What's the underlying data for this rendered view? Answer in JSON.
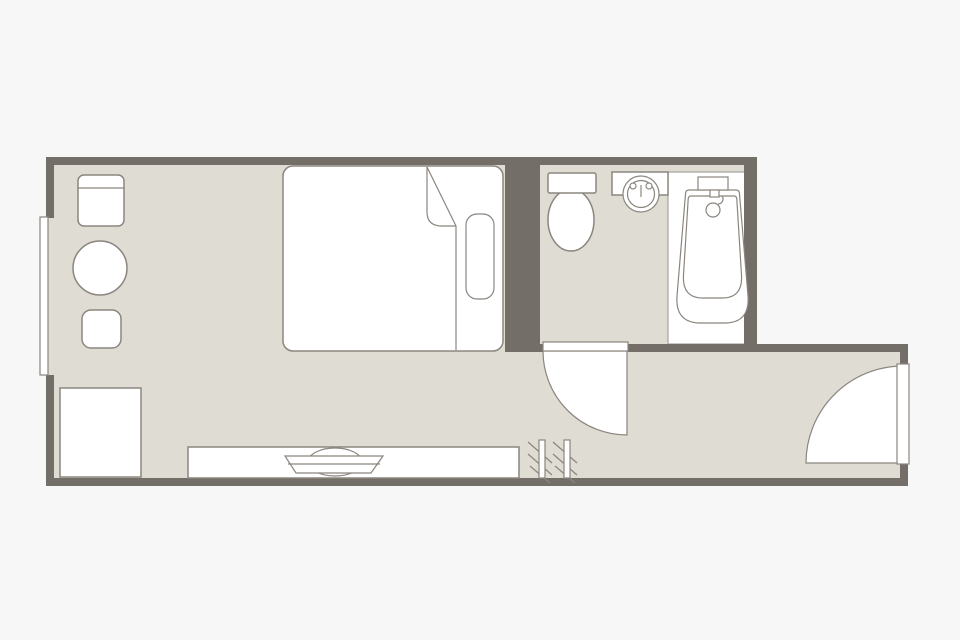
{
  "colors": {
    "background": "#f7f7f7",
    "floor": "#dfdcd4",
    "wall": "#746e68",
    "fixture": "#ffffff",
    "outline": "#8b857e",
    "deck_outline": "#a8a29b"
  },
  "plan": {
    "type": "hotel-room-floor-plan",
    "rooms": [
      "bedroom",
      "bathroom",
      "entry-corridor"
    ],
    "bedroom_items": [
      "armchair",
      "round-table",
      "stool",
      "double-bed",
      "pillow",
      "duvet-fold",
      "luggage-rack",
      "tv-counter",
      "television",
      "coat-hanger-rack",
      "window"
    ],
    "bathroom_items": [
      "toilet",
      "washbasin",
      "bathtub",
      "bathtub-deck"
    ],
    "doors": [
      "bathroom-door",
      "entrance-door"
    ]
  }
}
